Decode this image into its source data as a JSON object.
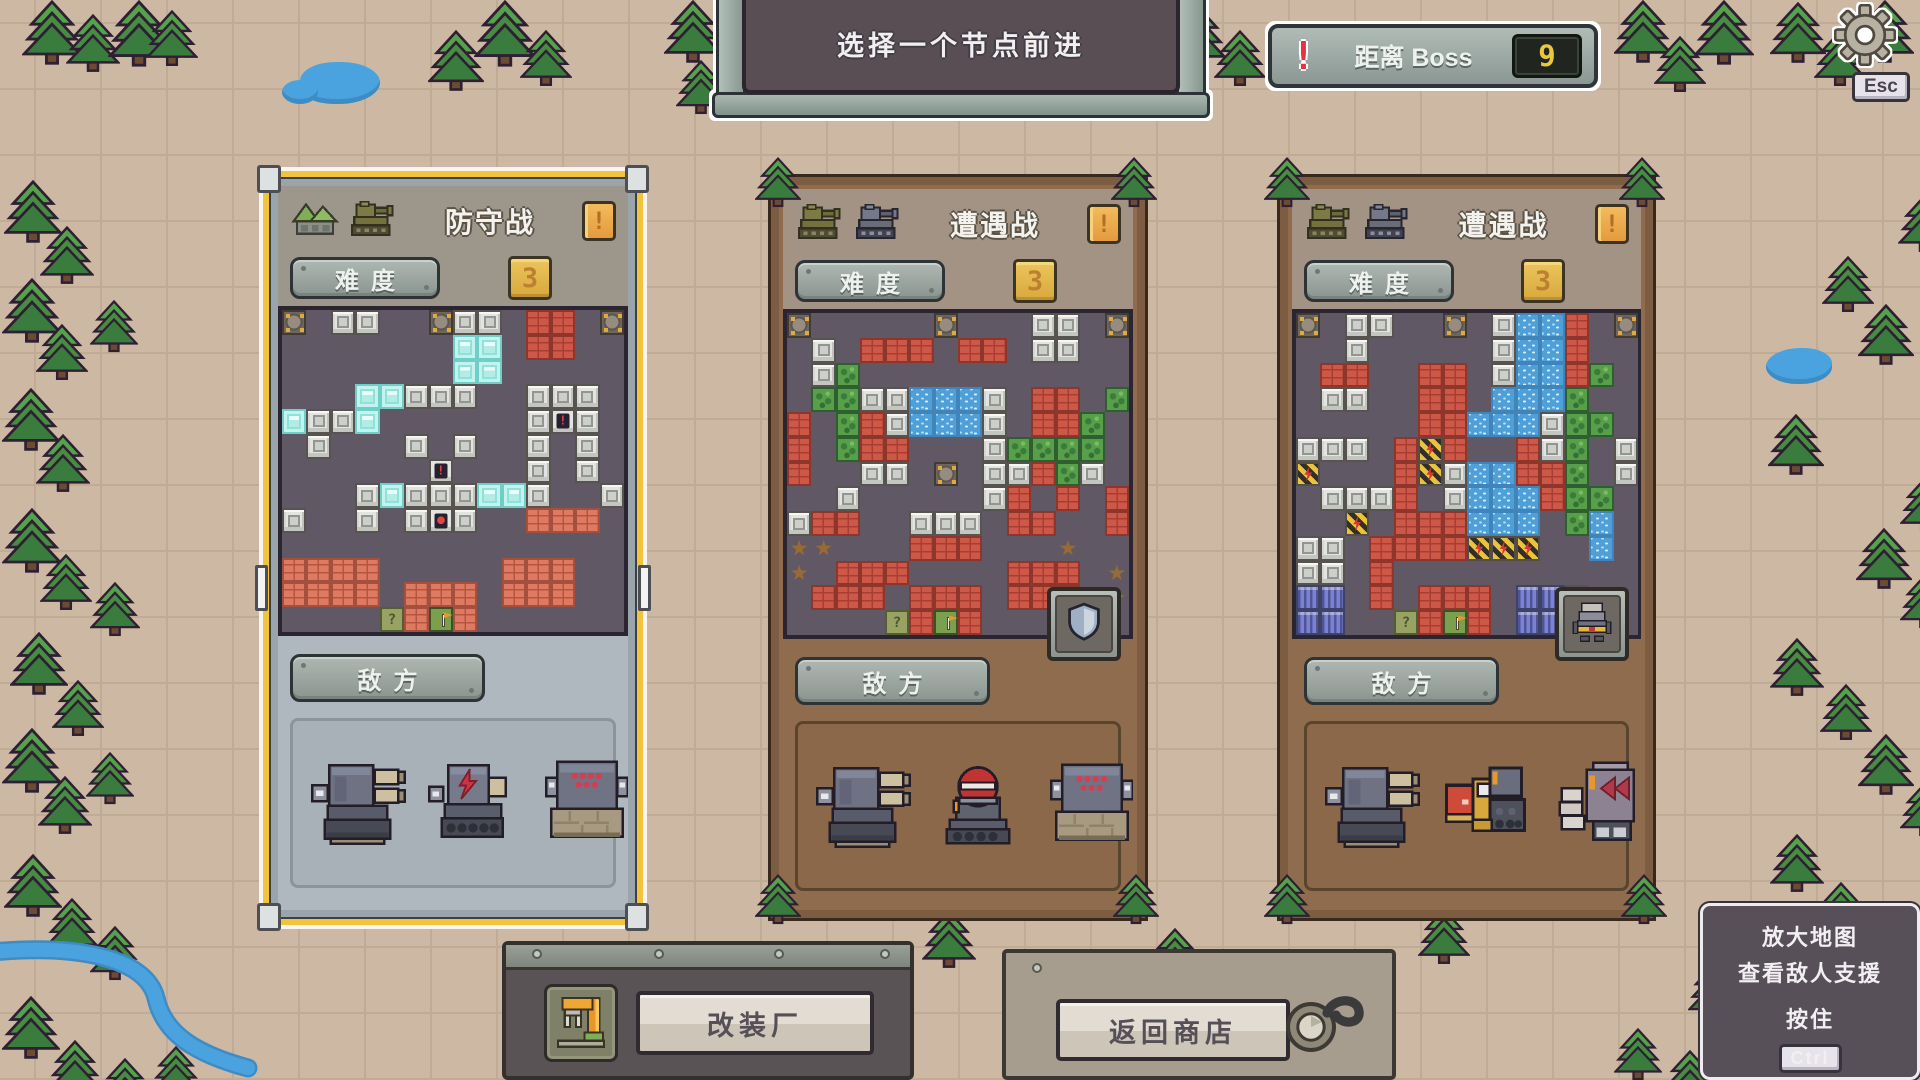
{
  "colors": {
    "background": "#cdb9a3",
    "selected_border": "#f2c43d",
    "wood_border": "#7d5d41",
    "map_background": "#615865",
    "water": "#4aa3df",
    "tree_green": "#448b41",
    "boss_value_color": "#e9c83b",
    "alert_red": "#e8313f",
    "gold_badge": "#e2b04a"
  },
  "top_banner": {
    "text": "选择一个节点前进"
  },
  "boss_indicator": {
    "alert": "!",
    "label": "距离 Boss",
    "value": "9"
  },
  "settings": {
    "gear_icon": "gear-icon",
    "key_hint": "Esc"
  },
  "tile_legend": {
    "M": "metal-block",
    "B": "brick",
    "b": "light-brick",
    "I": "ice-block",
    "W": "water",
    "G": "bush",
    "H": "electric-hazard",
    "C": "anchor-corner",
    "S": "spike",
    "P": "container",
    "F": "spawn-flag",
    "Q": "mission-tile",
    "E": "alert-tile",
    "R": "loot-tile",
    ".": "empty"
  },
  "nodes": [
    {
      "title": "防守战",
      "selected": true,
      "icons": [
        "mountain-base-icon",
        "olive-tank-icon"
      ],
      "alert": "!",
      "difficulty": {
        "label": "难度",
        "value": "3"
      },
      "enemy_label": "敌方",
      "support_badge": null,
      "enemies": [
        "twin-cannon-tank",
        "lightning-tank",
        "minigun-tank"
      ],
      "map": [
        "C.MM..CMM.BB.C",
        ".......II.BB..",
        ".......II.....",
        "...IIMMM..MMM.",
        "IMMI......MEM.",
        ".M...M.M..M.M.",
        "......E...M.M.",
        "...MIMMMIIM..M",
        "M..M.MRM..bbb.",
        "..............",
        "bbbb.....bbb..",
        "bbbb.bbb.bbb..",
        "....QbFb......"
      ]
    },
    {
      "title": "遭遇战",
      "selected": false,
      "icons": [
        "olive-tank-icon",
        "gray-tank-icon"
      ],
      "alert": "!",
      "difficulty": {
        "label": "难度",
        "value": "3"
      },
      "enemy_label": "敌方",
      "support_badge": "shield-icon",
      "enemies": [
        "twin-cannon-tank",
        "missile-dome-tank",
        "minigun-tank"
      ],
      "map": [
        "C.....C...MM.C",
        ".M.BBB.BB.MM..",
        ".MG...........",
        ".GGMMWWWM.BB.G",
        "B.GBMWWWM.BBG.",
        "B.GBB...MGGGG.",
        "B..MM.C.MMBGM.",
        "..M.....MB.B.B",
        "MBB..MMM.BB..B",
        "SS...BBB...S..",
        "S.BBB....BBB.S",
        ".BBB.BBB.BBB.S",
        "....QBFB......"
      ]
    },
    {
      "title": "遭遇战",
      "selected": false,
      "icons": [
        "olive-tank-icon",
        "gray-tank-icon"
      ],
      "alert": "!",
      "difficulty": {
        "label": "难度",
        "value": "3"
      },
      "enemy_label": "敌方",
      "support_badge": "mech-unit-icon",
      "enemies": [
        "twin-cannon-tank",
        "dozer-tank",
        "assault-mech"
      ],
      "map": [
        "C.MM..C.MWWB.C",
        "..M.....MWWB..",
        ".BB..BB.MWWBG.",
        ".MM..BB.WWWG..",
        ".....BBWWWMGG.",
        "MMM.BHB..BMG.M",
        "H...BHMWWBBG.M",
        ".MMMB.MWWWBGG.",
        "..H.BBBWWW.GW.",
        "MM.BBBBHHH..W.",
        "MM.B..........",
        "PP.B.BBB.PPM..",
        "PP..QBFB.PPP.."
      ]
    }
  ],
  "footer": {
    "factory_button": "改装厂",
    "shop_button": "返回商店"
  },
  "hint_panel": {
    "line1": "放大地图",
    "line2": "查看敌人支援",
    "line3": "按住",
    "key": "Ctrl"
  }
}
